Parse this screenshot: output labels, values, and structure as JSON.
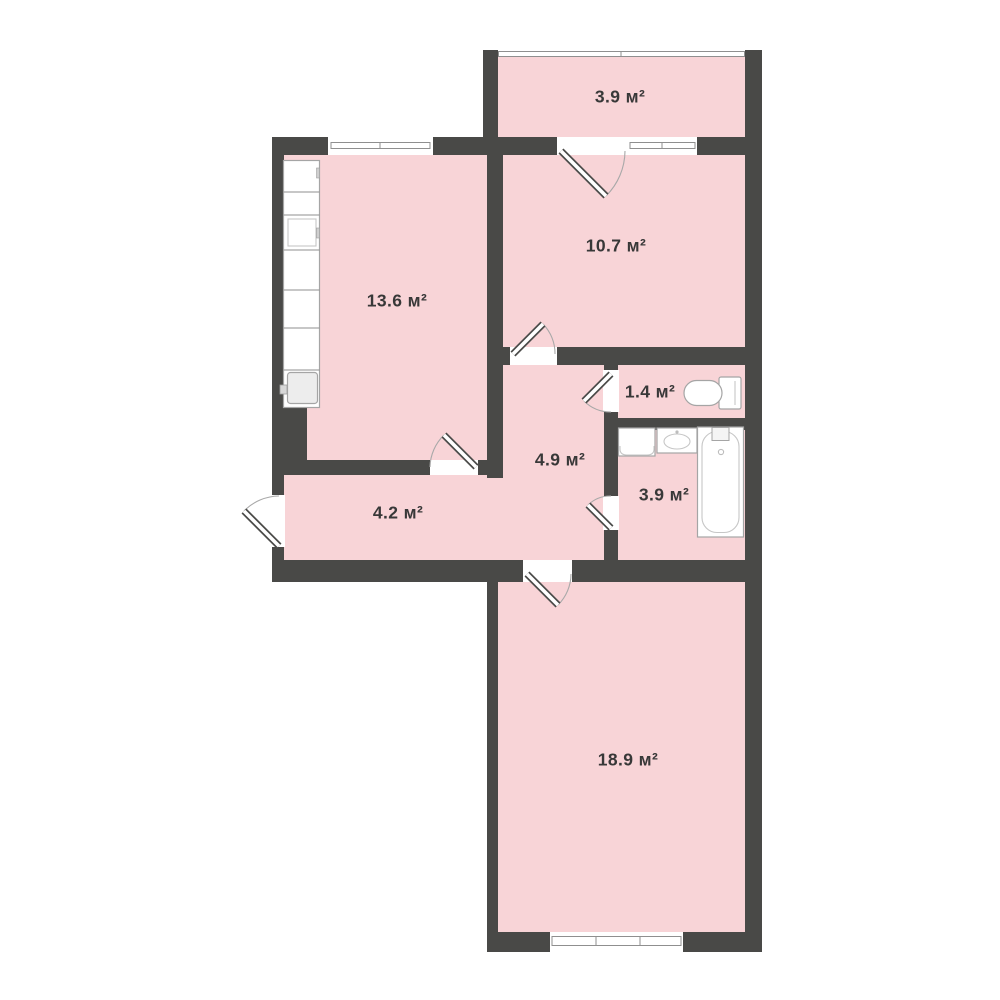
{
  "plan": {
    "type": "apartment-floor-plan",
    "unit": "м²",
    "colors": {
      "wall": "#494947",
      "floor_fill": "#f8d4d7",
      "background": "#ffffff",
      "label_text": "#383838",
      "fixture_line": "#a5a5a5"
    },
    "total_rooms": 8
  },
  "rooms": {
    "balcony": {
      "name": "balcony",
      "label": "3.9 м²",
      "area_m2": 3.9
    },
    "bedroom": {
      "name": "bedroom",
      "label": "10.7 м²",
      "area_m2": 10.7
    },
    "kitchen": {
      "name": "kitchen",
      "label": "13.6 м²",
      "area_m2": 13.6
    },
    "toilet": {
      "name": "toilet",
      "label": "1.4 м²",
      "area_m2": 1.4
    },
    "hallway": {
      "name": "hallway",
      "label": "4.9 м²",
      "area_m2": 4.9
    },
    "bathroom": {
      "name": "bathroom",
      "label": "3.9 м²",
      "area_m2": 3.9
    },
    "corridor": {
      "name": "corridor",
      "label": "4.2 м²",
      "area_m2": 4.2
    },
    "living_room": {
      "name": "living-room",
      "label": "18.9 м²",
      "area_m2": 18.9
    }
  },
  "fixtures": [
    "kitchen-counter",
    "kitchen-sink",
    "kitchen-stove",
    "toilet-bowl",
    "washing-machine",
    "bathroom-sink",
    "bathtub"
  ],
  "openings": [
    "entrance-door",
    "kitchen-door",
    "balcony-door",
    "bedroom-door",
    "toilet-door",
    "bathroom-door",
    "living-room-door",
    "kitchen-window",
    "bedroom-window",
    "balcony-glazing",
    "living-room-window"
  ]
}
